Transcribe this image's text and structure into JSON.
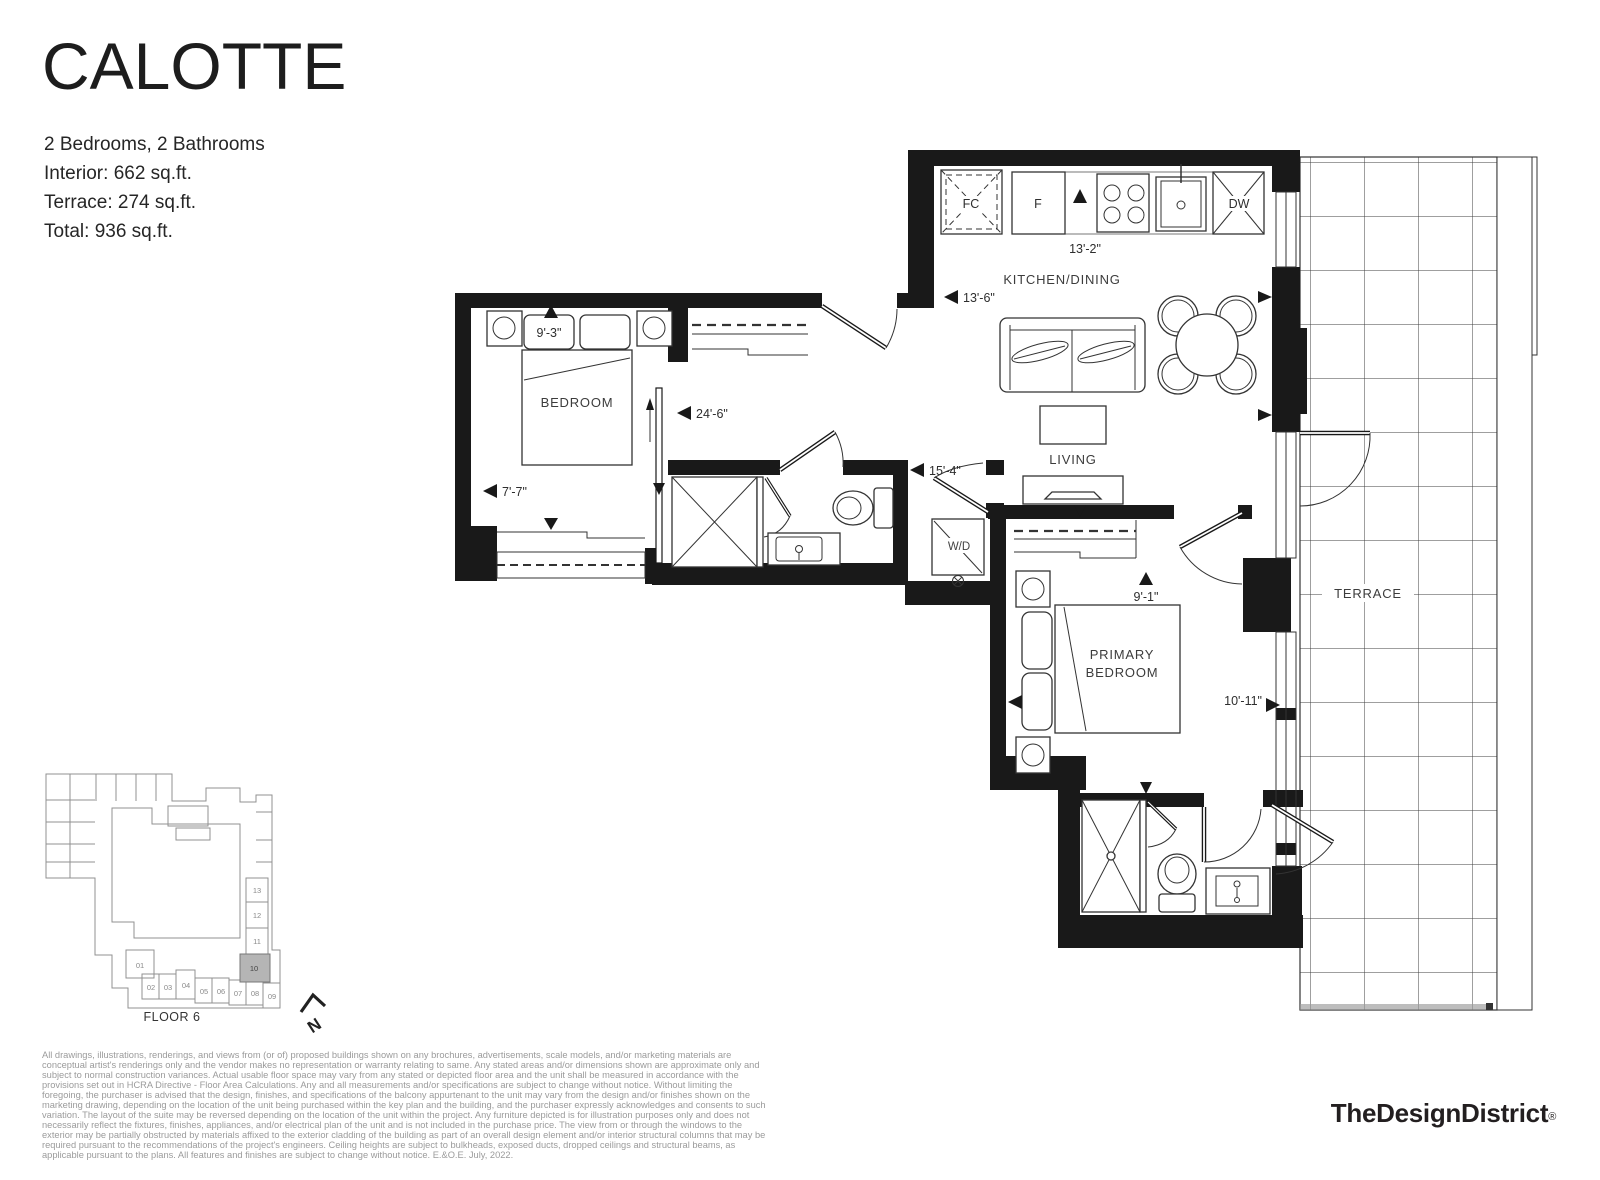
{
  "header": {
    "title": "CALOTTE",
    "specs": [
      "2 Bedrooms, 2 Bathrooms",
      "Interior: 662 sq.ft.",
      "Terrace: 274 sq.ft.",
      "Total: 936 sq.ft."
    ]
  },
  "plan": {
    "labels": {
      "kitchen_dining": "KITCHEN/DINING",
      "living": "LIVING",
      "bedroom": "BEDROOM",
      "primary_line1": "PRIMARY",
      "primary_line2": "BEDROOM",
      "terrace": "TERRACE"
    },
    "appliances": {
      "fc": "FC",
      "fridge": "F",
      "dishwasher": "DW",
      "washer_dryer": "W/D"
    },
    "dims": {
      "kitchen_counter": "13'-2\"",
      "kitchen_depth": "13'-6\"",
      "unit_length": "24'-6\"",
      "bedroom_width": "7'-7\"",
      "bedroom_depth": "9'-3\"",
      "hall_length": "15'-4\"",
      "primary_width": "9'-1\"",
      "primary_depth": "10'-11\""
    }
  },
  "keyplan": {
    "floor_label": "FLOOR 6",
    "units": [
      "01",
      "02",
      "03",
      "04",
      "05",
      "06",
      "07",
      "08",
      "09",
      "10",
      "11",
      "12",
      "13"
    ],
    "highlighted_unit": "10",
    "north_label": "N"
  },
  "footer": {
    "disclaimer": "All drawings, illustrations, renderings, and views from (or of) proposed buildings shown on any brochures, advertisements, scale models, and/or marketing materials are conceptual artist's renderings only and the vendor makes no representation or warranty relating to same. Any stated areas and/or dimensions shown are approximate only and subject to normal construction variances. Actual usable floor space may vary from any stated or depicted floor area and the unit shall be measured in accordance with the provisions set out in HCRA Directive - Floor Area Calculations. Any and all measurements and/or specifications are subject to change without notice. Without limiting the foregoing, the purchaser is advised that the design, finishes, and specifications of the balcony appurtenant to the unit may vary from the design and/or finishes shown on the marketing drawing, depending on the location of the unit being purchased within the key plan and the building, and the purchaser expressly acknowledges and consents to such variation. The layout of the suite may be reversed depending on the location of the unit within the project. Any furniture depicted is for illustration purposes only and does not necessarily reflect the fixtures, finishes, appliances, and/or electrical plan of the unit and is not included in the purchase price. The view from or through the windows to the exterior may be partially obstructed by materials affixed to the exterior cladding of the building as part of an overall design element and/or interior structural columns that may be required pursuant to the recommendations of the project's engineers. Ceiling heights are subject to bulkheads, exposed ducts, dropped ceilings and structural beams, as applicable pursuant to the plans. All features and finishes are subject to change without notice. E.&O.E. July, 2022.",
    "brand": "TheDesignDistrict",
    "reg": "®"
  }
}
